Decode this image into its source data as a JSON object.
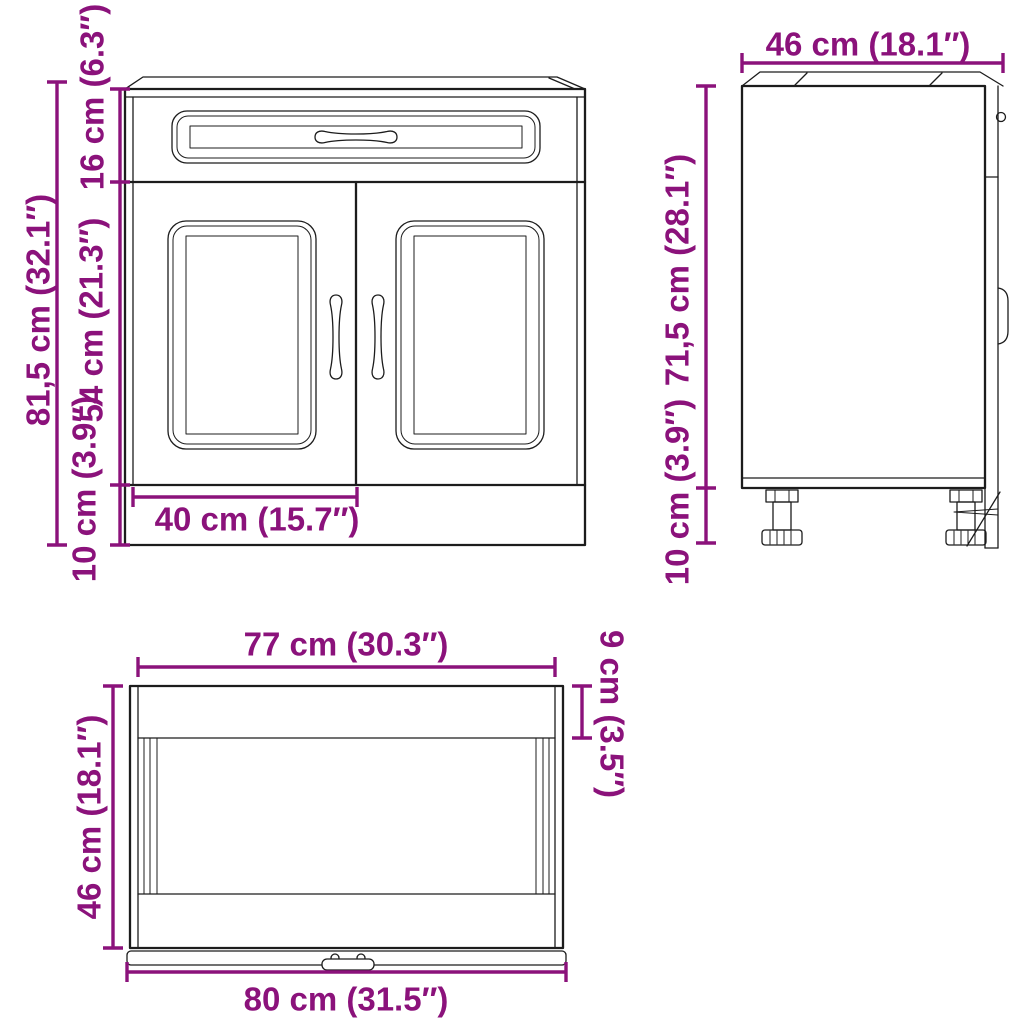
{
  "palette": {
    "dimension_color": "#8b127b",
    "line_color": "#1c1c1c",
    "background": "#ffffff"
  },
  "front_view": {
    "total_height": "81,5 cm (32.1″)",
    "drawer_height": "16 cm (6.3″)",
    "door_height": "54 cm (21.3″)",
    "base_height": "10 cm (3.9″)",
    "door_width": "40 cm (15.7″)"
  },
  "side_view": {
    "depth": "46 cm (18.1″)",
    "body_height": "71,5 cm (28.1″)",
    "leg_height": "10 cm (3.9″)"
  },
  "top_view": {
    "carcass_width": "77 cm (30.3″)",
    "top_rail_depth": "9 cm (3.5″)",
    "depth": "46 cm (18.1″)",
    "total_width": "80 cm (31.5″)"
  }
}
